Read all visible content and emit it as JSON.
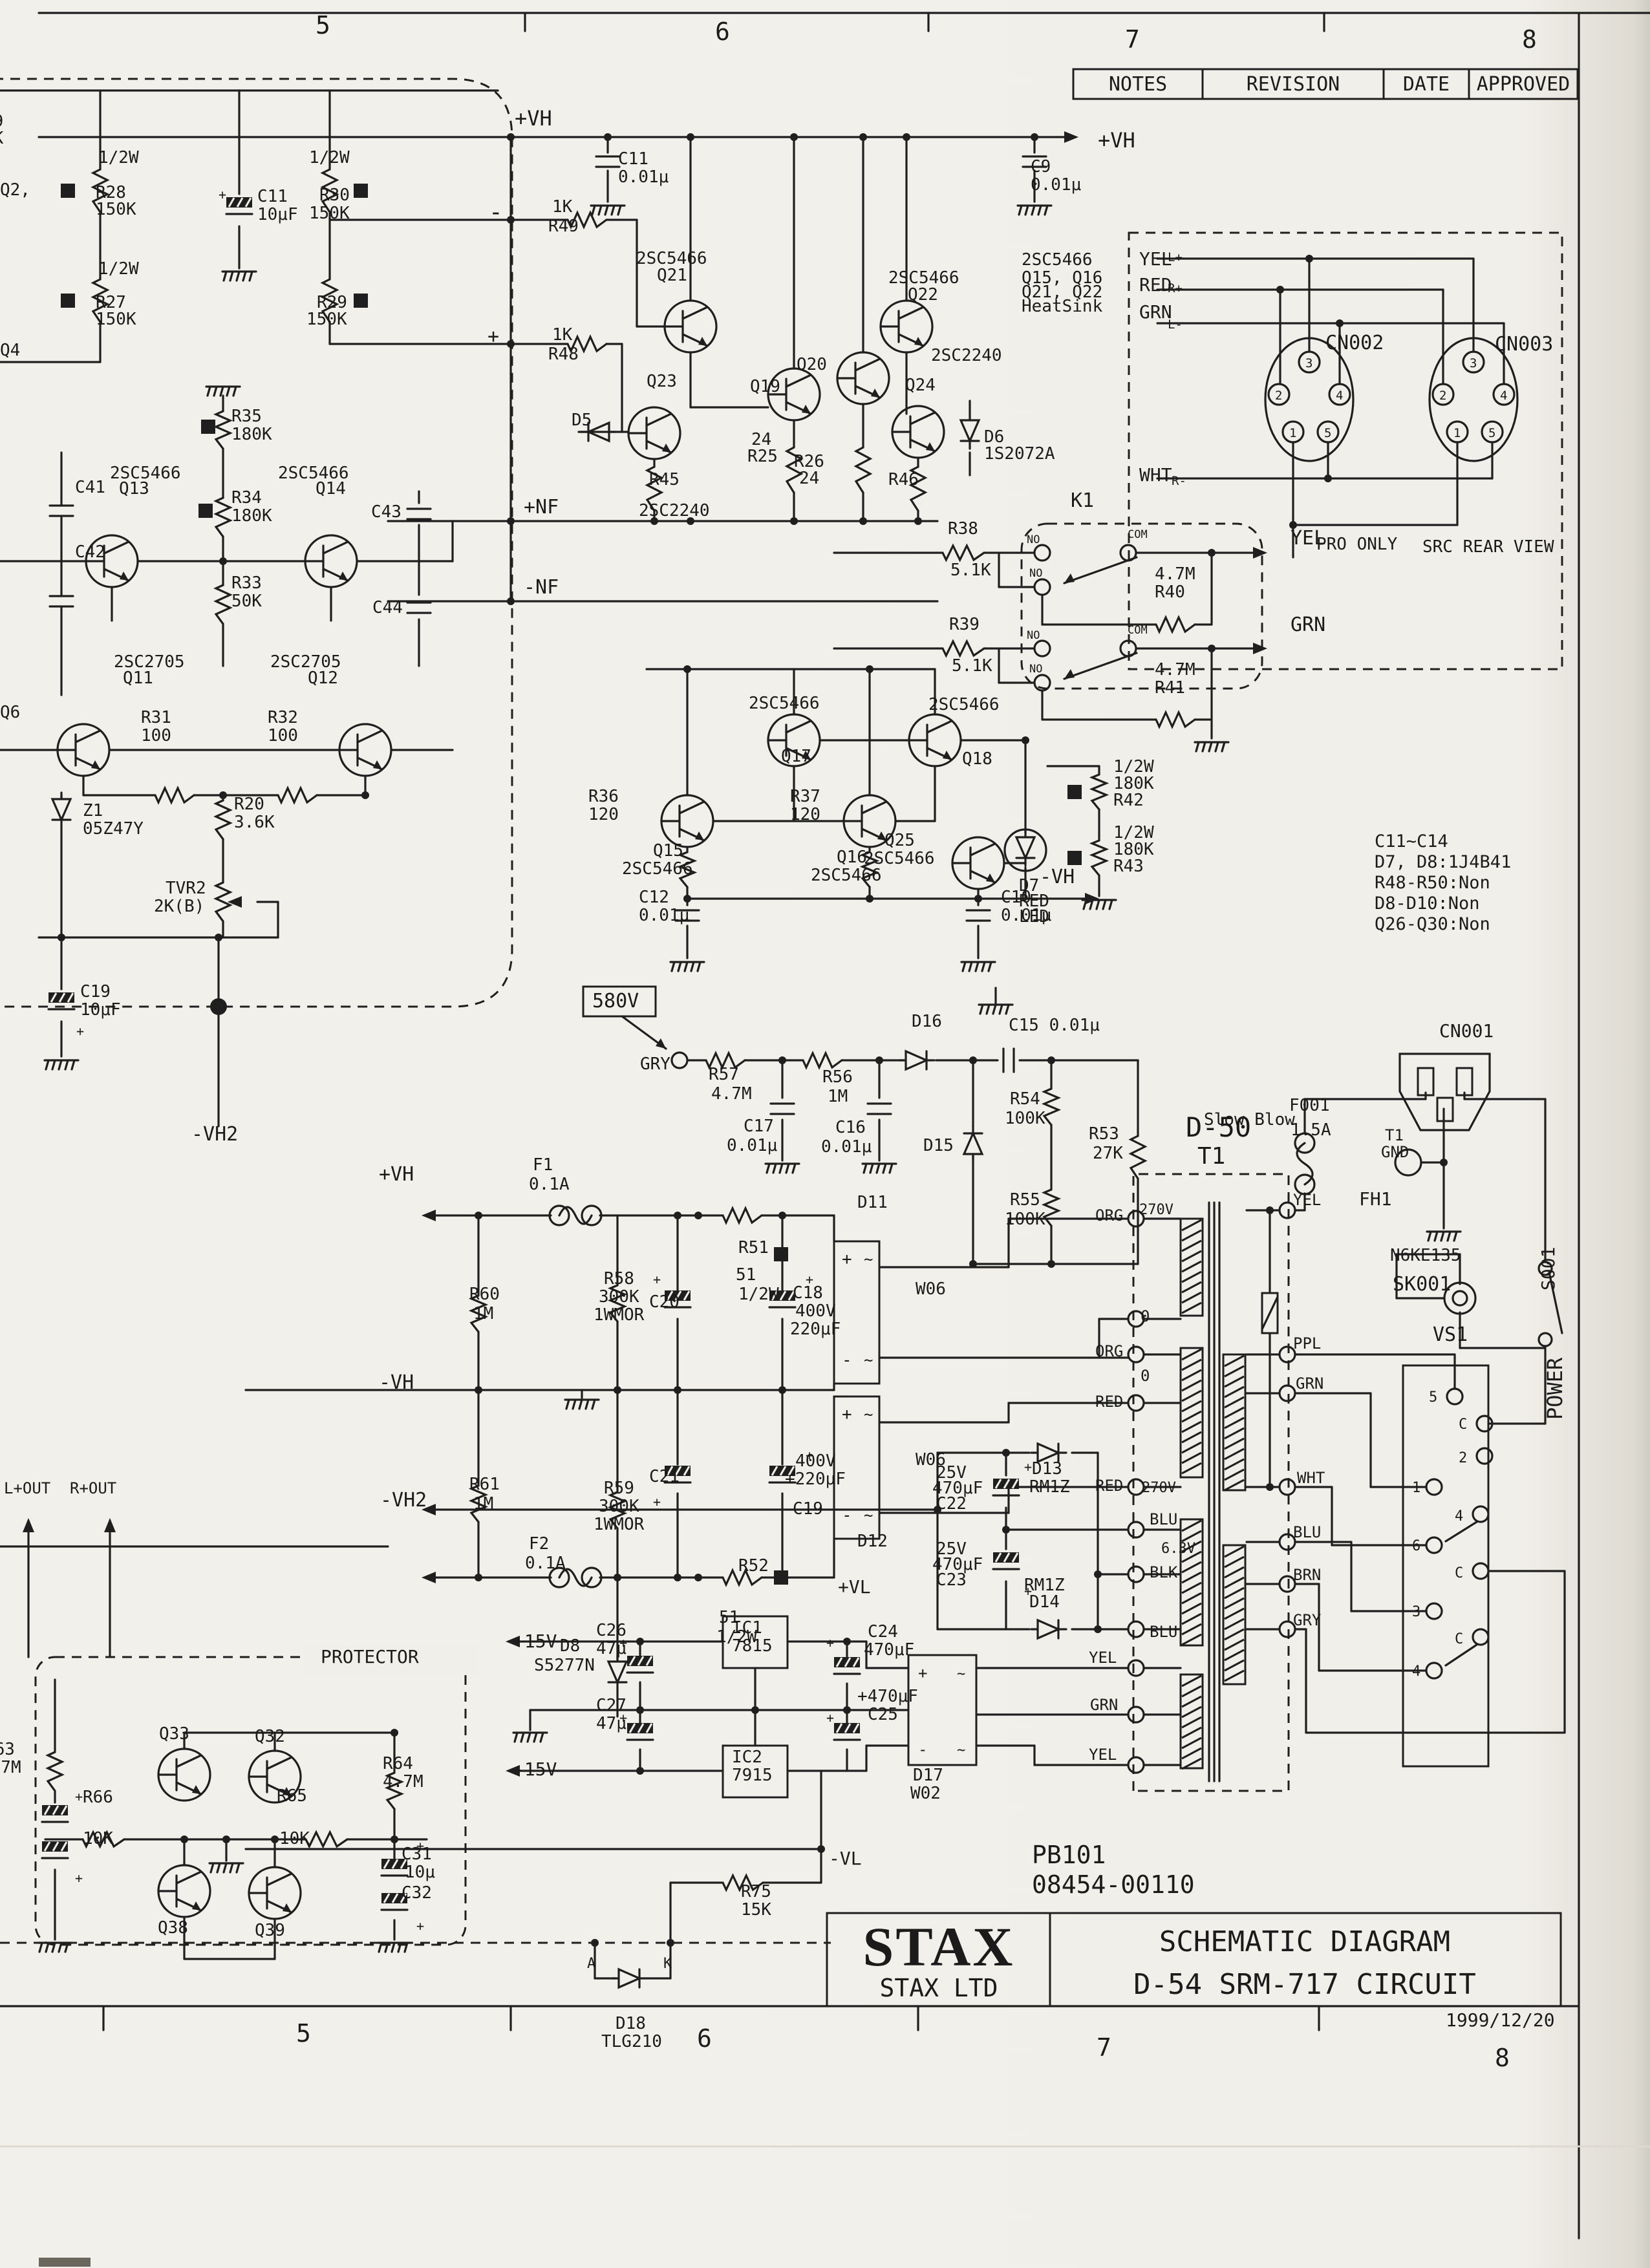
{
  "page": {
    "background": "#f1efe9",
    "ink": "#1b1b1b"
  },
  "rev_table": {
    "cols": [
      "NOTES",
      "REVISION",
      "DATE",
      "APPROVED"
    ]
  },
  "title_block": {
    "logo": "STAX",
    "company": "STAX LTD",
    "line1": "SCHEMATIC DIAGRAM",
    "line2": "D-54 SRM-717 CIRCUIT",
    "date": "1999/12/20"
  },
  "doc_numbers": {
    "pcb": "PB101",
    "code": "08454-00110"
  },
  "notes": [
    "C11~C14",
    "D7, D8:1J4B41",
    "R48-R50:Non",
    "D8-D10:Non",
    "Q26-Q30:Non"
  ],
  "grid": {
    "top": [
      "5",
      "6",
      "7",
      "8"
    ],
    "bottom": [
      "5",
      "6",
      "7",
      "8"
    ]
  },
  "connectors": {
    "cn002": "CN002",
    "cn003": "CN003",
    "cn001": "CN001",
    "pro_only": "PRO ONLY",
    "src_rear_view": "SRC REAR VIEW"
  },
  "labels": [
    [
      488,
      52,
      "5",
      38
    ],
    [
      1106,
      62,
      "6",
      38
    ],
    [
      1740,
      74,
      "7",
      38
    ],
    [
      2354,
      74,
      "8",
      38
    ],
    [
      458,
      3158,
      "5",
      38
    ],
    [
      1078,
      3166,
      "6",
      38
    ],
    [
      1696,
      3180,
      "7",
      38
    ],
    [
      2312,
      3196,
      "8",
      38
    ],
    [
      2236,
      3134,
      "1999/12/20",
      28
    ],
    [
      -26,
      196,
      "R9"
    ],
    [
      -26,
      222,
      "1K"
    ],
    [
      0,
      302,
      "Q2,"
    ],
    [
      0,
      550,
      "Q4"
    ],
    [
      0,
      1110,
      "Q6"
    ],
    [
      152,
      252,
      "1/2W"
    ],
    [
      148,
      306,
      "R28"
    ],
    [
      148,
      332,
      "150K"
    ],
    [
      398,
      312,
      "C11"
    ],
    [
      398,
      340,
      "10μF"
    ],
    [
      478,
      252,
      "1/2W"
    ],
    [
      494,
      310,
      "R30"
    ],
    [
      478,
      338,
      "150K"
    ],
    [
      152,
      424,
      "1/2W"
    ],
    [
      148,
      476,
      "R27"
    ],
    [
      148,
      502,
      "150K"
    ],
    [
      490,
      476,
      "R29"
    ],
    [
      474,
      502,
      "150K"
    ],
    [
      358,
      652,
      "R35"
    ],
    [
      358,
      680,
      "180K"
    ],
    [
      358,
      778,
      "R34"
    ],
    [
      358,
      806,
      "180K"
    ],
    [
      170,
      740,
      "2SC5466"
    ],
    [
      184,
      764,
      "Q13"
    ],
    [
      430,
      740,
      "2SC5466"
    ],
    [
      488,
      764,
      "Q14"
    ],
    [
      116,
      762,
      "C41"
    ],
    [
      116,
      862,
      "C42"
    ],
    [
      574,
      800,
      "C43"
    ],
    [
      576,
      948,
      "C44"
    ],
    [
      358,
      910,
      "R33"
    ],
    [
      358,
      938,
      "50K"
    ],
    [
      810,
      794,
      "+NF",
      30
    ],
    [
      810,
      918,
      "-NF",
      30
    ],
    [
      176,
      1032,
      "2SC2705"
    ],
    [
      190,
      1057,
      "Q11"
    ],
    [
      418,
      1032,
      "2SC2705"
    ],
    [
      476,
      1057,
      "Q12"
    ],
    [
      218,
      1118,
      "R31"
    ],
    [
      218,
      1146,
      "100"
    ],
    [
      414,
      1118,
      "R32"
    ],
    [
      414,
      1146,
      "100"
    ],
    [
      128,
      1262,
      "Z1"
    ],
    [
      128,
      1290,
      "05Z47Y"
    ],
    [
      362,
      1252,
      "R20"
    ],
    [
      362,
      1280,
      "3.6K"
    ],
    [
      256,
      1382,
      "TVR2"
    ],
    [
      238,
      1410,
      "2K(B)"
    ],
    [
      124,
      1542,
      "C19"
    ],
    [
      124,
      1570,
      "10μF"
    ],
    [
      296,
      1764,
      "-VH2",
      30
    ],
    [
      796,
      194,
      "+VH",
      32
    ],
    [
      956,
      254,
      "C11"
    ],
    [
      956,
      282,
      "0.01μ"
    ],
    [
      1698,
      228,
      "+VH",
      32
    ],
    [
      1594,
      266,
      "C9"
    ],
    [
      1594,
      294,
      "0.01μ"
    ],
    [
      854,
      328,
      "1K"
    ],
    [
      848,
      358,
      "R49"
    ],
    [
      756,
      340,
      "-",
      36
    ],
    [
      854,
      526,
      "1K"
    ],
    [
      848,
      556,
      "R48"
    ],
    [
      754,
      530,
      "+",
      30
    ],
    [
      984,
      408,
      "2SC5466"
    ],
    [
      1016,
      434,
      "Q21"
    ],
    [
      1374,
      438,
      "2SC5466"
    ],
    [
      1404,
      464,
      "Q22"
    ],
    [
      1580,
      410,
      "2SC5466"
    ],
    [
      1580,
      438,
      "Q15, Q16"
    ],
    [
      1580,
      460,
      "Q21, Q22"
    ],
    [
      1580,
      482,
      "HeatSink"
    ],
    [
      1440,
      558,
      "2SC2240"
    ],
    [
      1000,
      598,
      "Q23"
    ],
    [
      1160,
      606,
      "Q19"
    ],
    [
      1232,
      572,
      "Q20"
    ],
    [
      1400,
      604,
      "Q24"
    ],
    [
      884,
      658,
      "D5"
    ],
    [
      1522,
      684,
      "D6"
    ],
    [
      1522,
      710,
      "1S2072A"
    ],
    [
      1004,
      750,
      "R45"
    ],
    [
      1162,
      688,
      "24"
    ],
    [
      1156,
      714,
      "R25"
    ],
    [
      1228,
      722,
      "R26"
    ],
    [
      1236,
      748,
      "24"
    ],
    [
      1374,
      750,
      "R46"
    ],
    [
      988,
      798,
      "2SC2240"
    ],
    [
      1656,
      784,
      "K1",
      30
    ],
    [
      1466,
      826,
      "R38"
    ],
    [
      1470,
      890,
      "5.1K"
    ],
    [
      1468,
      974,
      "R39"
    ],
    [
      1472,
      1038,
      "5.1K"
    ],
    [
      1588,
      840,
      "NO",
      17
    ],
    [
      1744,
      832,
      "COM",
      17
    ],
    [
      1592,
      892,
      "NO",
      17
    ],
    [
      1588,
      988,
      "NO",
      17
    ],
    [
      1744,
      980,
      "COM",
      17
    ],
    [
      1592,
      1040,
      "NO",
      17
    ],
    [
      1786,
      896,
      "4.7M"
    ],
    [
      1786,
      924,
      "R40"
    ],
    [
      1786,
      1044,
      "4.7M"
    ],
    [
      1786,
      1072,
      "R41"
    ],
    [
      1996,
      842,
      "YEL",
      30
    ],
    [
      1996,
      976,
      "GRN",
      30
    ],
    [
      1158,
      1096,
      "2SC5466"
    ],
    [
      1208,
      1178,
      "Q17"
    ],
    [
      1436,
      1098,
      "2SC5466"
    ],
    [
      1488,
      1182,
      "Q18"
    ],
    [
      1010,
      1324,
      "Q15"
    ],
    [
      962,
      1352,
      "2SC5466"
    ],
    [
      1294,
      1334,
      "Q16"
    ],
    [
      1254,
      1362,
      "2SC5466"
    ],
    [
      1576,
      1378,
      "D7"
    ],
    [
      1576,
      1402,
      "RED"
    ],
    [
      1576,
      1426,
      "LED"
    ],
    [
      910,
      1240,
      "R36"
    ],
    [
      910,
      1268,
      "120"
    ],
    [
      1222,
      1240,
      "R37"
    ],
    [
      1222,
      1268,
      "120"
    ],
    [
      1368,
      1308,
      "Q25"
    ],
    [
      1336,
      1336,
      "2SC5466"
    ],
    [
      988,
      1396,
      "C12"
    ],
    [
      988,
      1424,
      "0.01μ"
    ],
    [
      1548,
      1396,
      "C10"
    ],
    [
      1548,
      1424,
      "0.01μ"
    ],
    [
      1608,
      1366,
      "-VH",
      30
    ],
    [
      1722,
      1194,
      "1/2W"
    ],
    [
      1722,
      1220,
      "180K"
    ],
    [
      1722,
      1246,
      "R42"
    ],
    [
      1722,
      1296,
      "1/2W"
    ],
    [
      1722,
      1322,
      "180K"
    ],
    [
      1722,
      1348,
      "R43"
    ],
    [
      916,
      1558,
      "580V",
      30
    ],
    [
      990,
      1654,
      "GRY"
    ],
    [
      1096,
      1670,
      "R57"
    ],
    [
      1100,
      1700,
      "4.7M"
    ],
    [
      1272,
      1674,
      "R56"
    ],
    [
      1280,
      1704,
      "1M"
    ],
    [
      1410,
      1588,
      "D16"
    ],
    [
      1560,
      1594,
      "C15 0.01μ"
    ],
    [
      1150,
      1750,
      "C17"
    ],
    [
      1124,
      1780,
      "0.01μ"
    ],
    [
      1292,
      1752,
      "C16"
    ],
    [
      1270,
      1782,
      "0.01μ"
    ],
    [
      1428,
      1780,
      "D15"
    ],
    [
      1562,
      1708,
      "R54"
    ],
    [
      1554,
      1738,
      "100K"
    ],
    [
      1562,
      1864,
      "R55"
    ],
    [
      1554,
      1894,
      "100K"
    ],
    [
      1684,
      1762,
      "R53"
    ],
    [
      1690,
      1792,
      "27K"
    ],
    [
      1138,
      1980,
      "51"
    ],
    [
      1142,
      2010,
      "1/2W"
    ],
    [
      1326,
      1868,
      "D11"
    ],
    [
      824,
      1810,
      "F1"
    ],
    [
      818,
      1840,
      "0.1A"
    ],
    [
      586,
      1826,
      "+VH",
      30
    ],
    [
      726,
      2010,
      "R60"
    ],
    [
      732,
      2040,
      "1M"
    ],
    [
      934,
      1986,
      "R58"
    ],
    [
      926,
      2014,
      "300K"
    ],
    [
      918,
      2042,
      "1WMOR"
    ],
    [
      1004,
      2022,
      "C20"
    ],
    [
      1142,
      1938,
      "R51"
    ],
    [
      1226,
      2008,
      "C18"
    ],
    [
      1230,
      2036,
      "400V"
    ],
    [
      1222,
      2064,
      "220μF"
    ],
    [
      1416,
      2002,
      "W06"
    ],
    [
      726,
      2304,
      "R61"
    ],
    [
      732,
      2334,
      "1M"
    ],
    [
      934,
      2310,
      "R59"
    ],
    [
      926,
      2338,
      "300K"
    ],
    [
      918,
      2366,
      "1WMOR"
    ],
    [
      1004,
      2292,
      "C21"
    ],
    [
      1230,
      2268,
      "400V"
    ],
    [
      1214,
      2296,
      "+220μF"
    ],
    [
      1226,
      2342,
      "C19"
    ],
    [
      1142,
      2430,
      "R52"
    ],
    [
      818,
      2396,
      "F2"
    ],
    [
      812,
      2426,
      "0.1A"
    ],
    [
      586,
      2148,
      "-VH",
      30
    ],
    [
      1112,
      2510,
      "51"
    ],
    [
      1108,
      2540,
      "1/2W"
    ],
    [
      1416,
      2266,
      "W06"
    ],
    [
      1326,
      2392,
      "D12"
    ],
    [
      866,
      2554,
      "D8"
    ],
    [
      826,
      2584,
      "S5277N"
    ],
    [
      588,
      2330,
      "-VH2",
      30
    ],
    [
      1596,
      2280,
      "D13"
    ],
    [
      1592,
      2308,
      "RM1Z"
    ],
    [
      1448,
      2286,
      "25V"
    ],
    [
      1442,
      2310,
      "470μF"
    ],
    [
      1448,
      2334,
      "C22"
    ],
    [
      1448,
      2404,
      "25V"
    ],
    [
      1442,
      2428,
      "470μF"
    ],
    [
      1448,
      2452,
      "C23"
    ],
    [
      1584,
      2460,
      "RM1Z"
    ],
    [
      1592,
      2486,
      "D14"
    ],
    [
      1778,
      2358,
      "BLU",
      24
    ],
    [
      1796,
      2402,
      "6.3V",
      22
    ],
    [
      1778,
      2440,
      "BLK",
      24
    ],
    [
      1778,
      2532,
      "BLU",
      24
    ],
    [
      1684,
      2572,
      "YEL",
      24
    ],
    [
      1686,
      2645,
      "GRN",
      24
    ],
    [
      1684,
      2722,
      "YEL",
      24
    ],
    [
      1834,
      1758,
      "D-50",
      42
    ],
    [
      1852,
      1800,
      "T1",
      36
    ],
    [
      1694,
      1888,
      "ORG",
      24
    ],
    [
      1762,
      1878,
      "270V",
      22
    ],
    [
      1764,
      2044,
      "0",
      24
    ],
    [
      1694,
      2098,
      "ORG",
      24
    ],
    [
      1764,
      2136,
      "0",
      24
    ],
    [
      1694,
      2176,
      "RED",
      24
    ],
    [
      1694,
      2306,
      "RED",
      24
    ],
    [
      1766,
      2308,
      "270V",
      22
    ],
    [
      2000,
      1864,
      "YEL",
      24
    ],
    [
      2102,
      1864,
      "FH1",
      28
    ],
    [
      1994,
      1718,
      "F001",
      26
    ],
    [
      1996,
      1756,
      "1.5A",
      26
    ],
    [
      1862,
      1740,
      "Slow Blow",
      26
    ],
    [
      2142,
      1764,
      "T1",
      24
    ],
    [
      2136,
      1790,
      "GND",
      24
    ],
    [
      2150,
      1950,
      "N6KE135",
      26
    ],
    [
      2154,
      1996,
      "SK001",
      30
    ],
    [
      2000,
      2086,
      "PPL",
      24
    ],
    [
      2004,
      2148,
      "GRN",
      24
    ],
    [
      2006,
      2294,
      "WHT",
      24
    ],
    [
      2000,
      2378,
      "BLU",
      24
    ],
    [
      2000,
      2444,
      "BRN",
      24
    ],
    [
      2000,
      2514,
      "GRY",
      24
    ],
    [
      2216,
      2074,
      "VS1",
      30
    ],
    [
      2210,
      2168,
      "5",
      22
    ],
    [
      2256,
      2210,
      "C",
      22
    ],
    [
      2256,
      2262,
      "2",
      22
    ],
    [
      2184,
      2308,
      "1",
      22
    ],
    [
      2250,
      2352,
      "4",
      22
    ],
    [
      2184,
      2398,
      "6",
      22
    ],
    [
      2250,
      2440,
      "C",
      22
    ],
    [
      2184,
      2500,
      "3",
      22
    ],
    [
      2250,
      2542,
      "C",
      22
    ],
    [
      2184,
      2592,
      "4",
      22
    ],
    [
      2404,
      1996,
      "S001",
      28,
      -90
    ],
    [
      2416,
      2196,
      "POWER",
      32,
      -90
    ],
    [
      2226,
      1604,
      "CN001",
      28
    ],
    [
      794,
      2548,
      "+15V",
      28
    ],
    [
      794,
      2746,
      "-15V",
      28
    ],
    [
      1296,
      2464,
      "+VL",
      28
    ],
    [
      1282,
      2884,
      "-VL",
      28
    ],
    [
      1132,
      2526,
      "IC1"
    ],
    [
      1132,
      2554,
      "7815"
    ],
    [
      1132,
      2726,
      "IC2"
    ],
    [
      1132,
      2754,
      "7915"
    ],
    [
      922,
      2530,
      "C26"
    ],
    [
      922,
      2558,
      "47μ"
    ],
    [
      922,
      2646,
      "C27"
    ],
    [
      922,
      2674,
      "47μ"
    ],
    [
      1342,
      2532,
      "C24"
    ],
    [
      1336,
      2560,
      "470μF"
    ],
    [
      1326,
      2632,
      "+470μF"
    ],
    [
      1342,
      2660,
      "C25"
    ],
    [
      1412,
      2754,
      "D17"
    ],
    [
      1408,
      2782,
      "W02"
    ],
    [
      496,
      2572,
      "PROTECTOR",
      28
    ],
    [
      246,
      2690,
      "Q33"
    ],
    [
      394,
      2694,
      "Q32"
    ],
    [
      244,
      2990,
      "Q38"
    ],
    [
      394,
      2994,
      "Q39"
    ],
    [
      128,
      2788,
      "R66"
    ],
    [
      128,
      2852,
      "10K"
    ],
    [
      428,
      2786,
      "R65"
    ],
    [
      432,
      2852,
      "10K"
    ],
    [
      592,
      2736,
      "R64"
    ],
    [
      592,
      2764,
      "4.7M"
    ],
    [
      621,
      2876,
      "C31"
    ],
    [
      626,
      2904,
      "10μ"
    ],
    [
      621,
      2936,
      "C32"
    ],
    [
      6,
      2310,
      "L+OUT",
      24
    ],
    [
      108,
      2310,
      "R+OUT",
      24
    ],
    [
      -24,
      2714,
      "R63"
    ],
    [
      -30,
      2742,
      "4.7M"
    ],
    [
      1146,
      2934,
      "R75"
    ],
    [
      1146,
      2962,
      "15K"
    ],
    [
      908,
      3044,
      "A",
      22
    ],
    [
      1026,
      3044,
      "K",
      22
    ],
    [
      952,
      3138,
      "D18"
    ],
    [
      930,
      3166,
      "TLG210"
    ],
    [
      2036,
      850,
      "PRO ONLY",
      26
    ],
    [
      2200,
      854,
      "SRC REAR VIEW",
      26
    ],
    [
      2050,
      540,
      "CN002",
      30
    ],
    [
      2312,
      542,
      "CN003",
      30
    ],
    [
      1762,
      410,
      "YEL",
      28
    ],
    [
      1762,
      450,
      "RED",
      28
    ],
    [
      1762,
      492,
      "GRN",
      28
    ],
    [
      1762,
      744,
      "WHT",
      28
    ],
    [
      1806,
      404,
      "L+",
      19
    ],
    [
      1806,
      452,
      "R+",
      19
    ],
    [
      1806,
      508,
      "L-",
      19
    ],
    [
      1812,
      750,
      "R-",
      19
    ],
    [
      2019,
      568,
      "3",
      19
    ],
    [
      1972,
      618,
      "2",
      19
    ],
    [
      2066,
      618,
      "4",
      19
    ],
    [
      1994,
      676,
      "1",
      19
    ],
    [
      2048,
      676,
      "5",
      19
    ],
    [
      2273,
      568,
      "3",
      19
    ],
    [
      2226,
      618,
      "2",
      19
    ],
    [
      2320,
      618,
      "4",
      19
    ],
    [
      2248,
      676,
      "1",
      19
    ],
    [
      2302,
      676,
      "5",
      19
    ],
    [
      1302,
      1956,
      "+",
      26
    ],
    [
      1336,
      1956,
      "~",
      24
    ],
    [
      1302,
      2112,
      "-",
      26
    ],
    [
      1336,
      2112,
      "~",
      24
    ],
    [
      1302,
      2196,
      "+",
      26
    ],
    [
      1336,
      2196,
      "~",
      24
    ],
    [
      1302,
      2352,
      "-",
      26
    ],
    [
      1336,
      2352,
      "~",
      24
    ],
    [
      1420,
      2596,
      "+",
      24
    ],
    [
      1480,
      2596,
      "~",
      22
    ],
    [
      1420,
      2714,
      "-",
      24
    ],
    [
      1480,
      2714,
      "~",
      22
    ],
    [
      338,
      308,
      "+",
      20
    ],
    [
      118,
      1602,
      "+",
      20
    ],
    [
      1010,
      1986,
      "+",
      20
    ],
    [
      1246,
      1986,
      "+",
      20
    ],
    [
      1010,
      2330,
      "+",
      20
    ],
    [
      1246,
      2258,
      "+",
      20
    ],
    [
      1584,
      2276,
      "+",
      20
    ],
    [
      1584,
      2468,
      "+",
      20
    ],
    [
      958,
      2548,
      "+",
      20
    ],
    [
      958,
      2664,
      "+",
      20
    ],
    [
      1278,
      2548,
      "+",
      20
    ],
    [
      1278,
      2664,
      "+",
      20
    ],
    [
      644,
      2862,
      "+",
      20
    ],
    [
      644,
      2986,
      "+",
      20
    ],
    [
      116,
      2786,
      "+",
      20
    ],
    [
      116,
      2912,
      "+",
      20
    ]
  ]
}
